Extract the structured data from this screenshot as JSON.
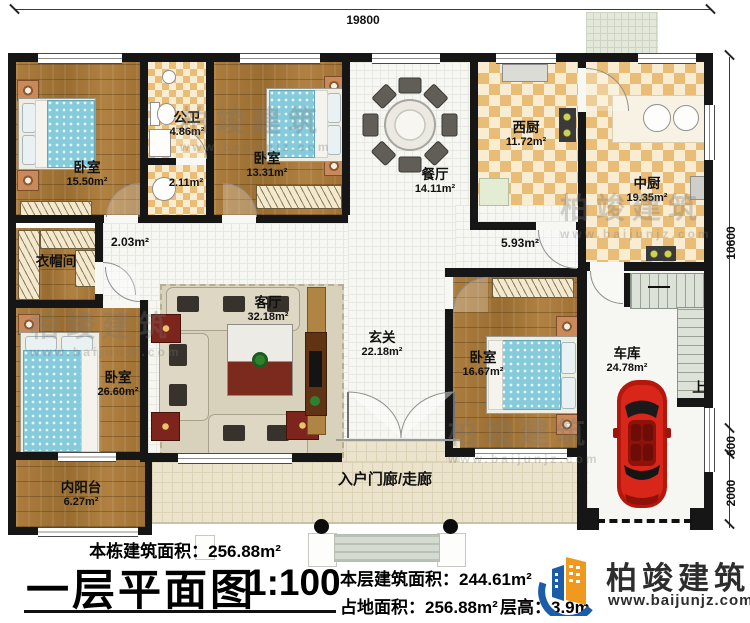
{
  "dimensions": {
    "top_width": "19800",
    "right_total": "10600",
    "right_mid": "600",
    "right_lower": "2000"
  },
  "rooms": {
    "bedroom_nw": {
      "name": "卧室",
      "area": "15.50m²"
    },
    "bath": {
      "name": "公卫",
      "area": "4.86m²"
    },
    "bath_small": {
      "area": "2.11m²"
    },
    "bedroom_n": {
      "name": "卧室",
      "area": "13.31m²"
    },
    "dining": {
      "name": "餐厅",
      "area": "14.11m²"
    },
    "west_kitchen": {
      "name": "西厨",
      "area": "11.72m²"
    },
    "main_kitchen": {
      "name": "中厨",
      "area": "19.35m²"
    },
    "cloakroom": {
      "name": "衣帽间"
    },
    "hall_west": {
      "area": "2.03m²"
    },
    "hall_east": {
      "area": "5.93m²"
    },
    "living": {
      "name": "客厅",
      "area": "32.18m²"
    },
    "foyer": {
      "name": "玄关",
      "area": "22.18m²"
    },
    "bedroom_sw": {
      "name": "卧室",
      "area": "26.60m²"
    },
    "balcony": {
      "name": "内阳台",
      "area": "6.27m²"
    },
    "bedroom_se": {
      "name": "卧室",
      "area": "16.67m²"
    },
    "garage": {
      "name": "车库",
      "area": "24.78m²"
    },
    "porch": {
      "name": "入户门廊/走廊"
    },
    "stairs": {
      "up_label": "上"
    }
  },
  "titleblock": {
    "building_total": "本栋建筑面积：256.88m²",
    "plan_title": "一层平面图",
    "scale": "1:100",
    "floor_area": "本层建筑面积：244.61m²",
    "land_area": "占地面积：256.88m²",
    "floor_height": "层高：3.9m"
  },
  "logo": {
    "brand": "柏竣建筑",
    "site": "www.baijunjz.com"
  },
  "watermark": {
    "brand": "柏竣建筑",
    "site": "www.baijunjz.com"
  },
  "colors": {
    "wall": "#161616",
    "logo_blue": "#1d5ca6",
    "logo_orange": "#ef9a1f",
    "car_red": "#c3180c"
  }
}
